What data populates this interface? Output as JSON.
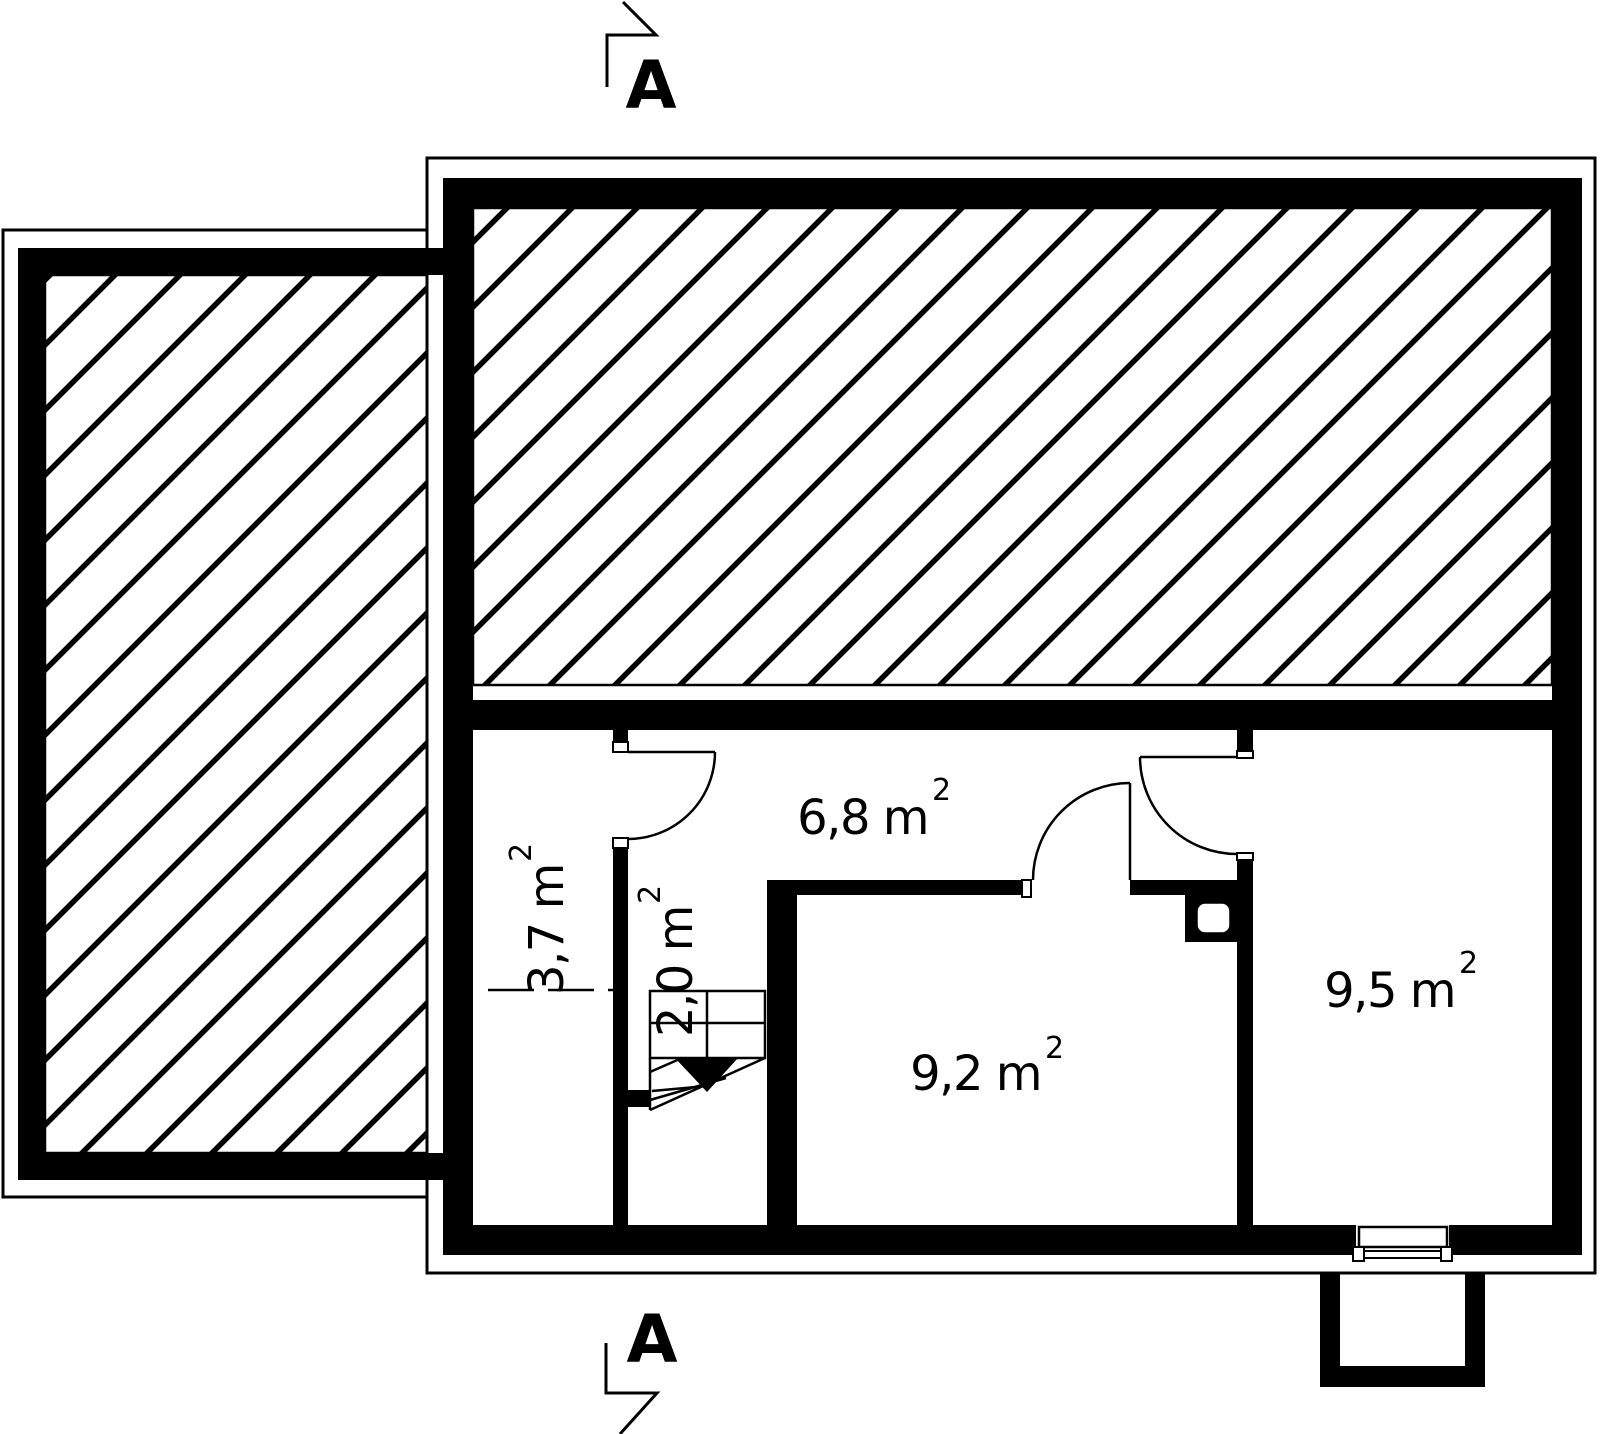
{
  "drawing": {
    "type": "floor-plan",
    "colors": {
      "ink": "#000000",
      "paper": "#ffffff"
    },
    "rooms": {
      "hall": {
        "area": "6,8 m",
        "sup": "2"
      },
      "room_37": {
        "area": "3,7 m",
        "sup": "2"
      },
      "stair": {
        "area": "2,0 m",
        "sup": "2"
      },
      "room_92": {
        "area": "9,2 m",
        "sup": "2"
      },
      "room_95": {
        "area": "9,5 m",
        "sup": "2"
      }
    },
    "section_markers": {
      "top": "A",
      "bottom": "A"
    }
  }
}
